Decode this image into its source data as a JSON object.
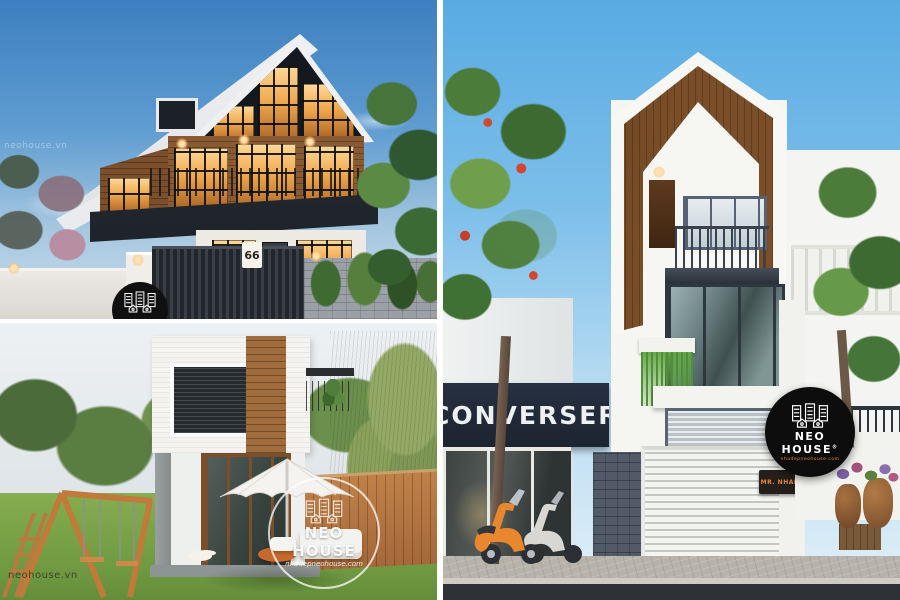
{
  "branding": {
    "badge": {
      "title": "NEO HOUSE",
      "reg": "®",
      "url": "nhadepneohouse.com"
    },
    "watermark_circle": {
      "title": "NEO HOUSE",
      "subtitle": "nhadepneohouse.com"
    },
    "corner_site": "neohouse.vn",
    "sky_watermark": "neohouse.vn"
  },
  "top_left_panel": {
    "house_number": "66"
  },
  "right_panel": {
    "shop_sign": "CONVERSER",
    "door_sign": "MR. NHAN"
  },
  "colors": {
    "sky_dusk": "#3d7fc0",
    "sky_day": "#58abe2",
    "warm_window": "#f0a84e",
    "wood": "#8a5a33",
    "gable_wood": "#7a4e28",
    "dark_frame": "#2c3138",
    "sign_navy": "#1c2430",
    "lawn_green": "#7aa647",
    "vespa_orange": "#e8872e",
    "badge_black": "#0d0d0d",
    "gutter_white": "#ffffff"
  }
}
